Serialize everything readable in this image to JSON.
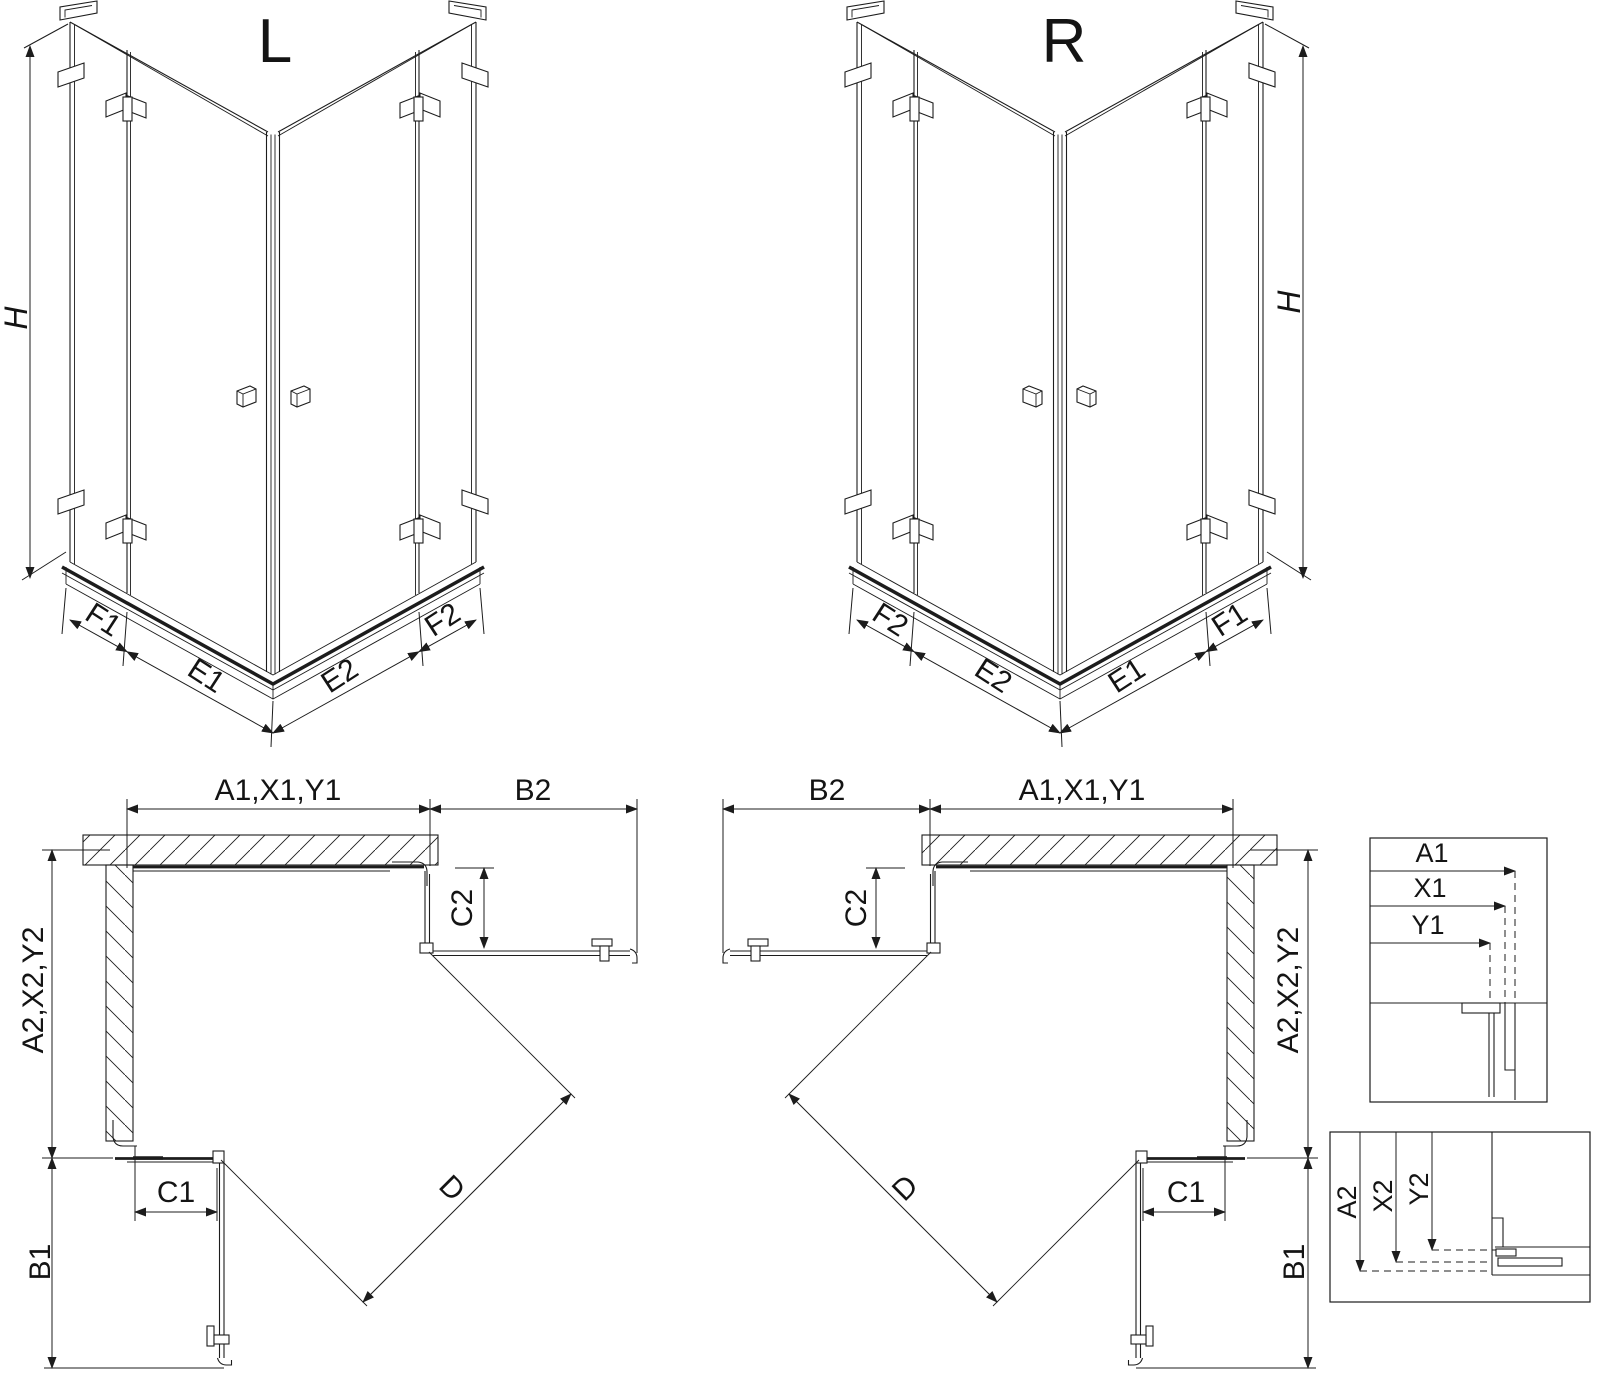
{
  "iso_left": {
    "title": "L",
    "height_label": "H",
    "segments": {
      "f1": "F1",
      "e1": "E1",
      "e2": "E2",
      "f2": "F2"
    }
  },
  "iso_right": {
    "title": "R",
    "height_label": "H",
    "segments": {
      "f2": "F2",
      "e2": "E2",
      "e1": "E1",
      "f1": "F1"
    }
  },
  "plan_left": {
    "width_top": "A1,X1,Y1",
    "door_top": "B2",
    "fixed_top": "C2",
    "depth_side": "A2,X2,Y2",
    "fixed_bottom": "C1",
    "door_bottom": "B1",
    "diagonal": "D"
  },
  "plan_right": {
    "width_top": "A1,X1,Y1",
    "door_top": "B2",
    "fixed_top": "C2",
    "depth_side": "A2,X2,Y2",
    "fixed_bottom": "C1",
    "door_bottom": "B1",
    "diagonal": "D"
  },
  "detail_width": {
    "a1": "A1",
    "x1": "X1",
    "y1": "Y1"
  },
  "detail_depth": {
    "a2": "A2",
    "x2": "X2",
    "y2": "Y2"
  },
  "colors": {
    "line": "#1c1c1c",
    "background": "#ffffff"
  }
}
